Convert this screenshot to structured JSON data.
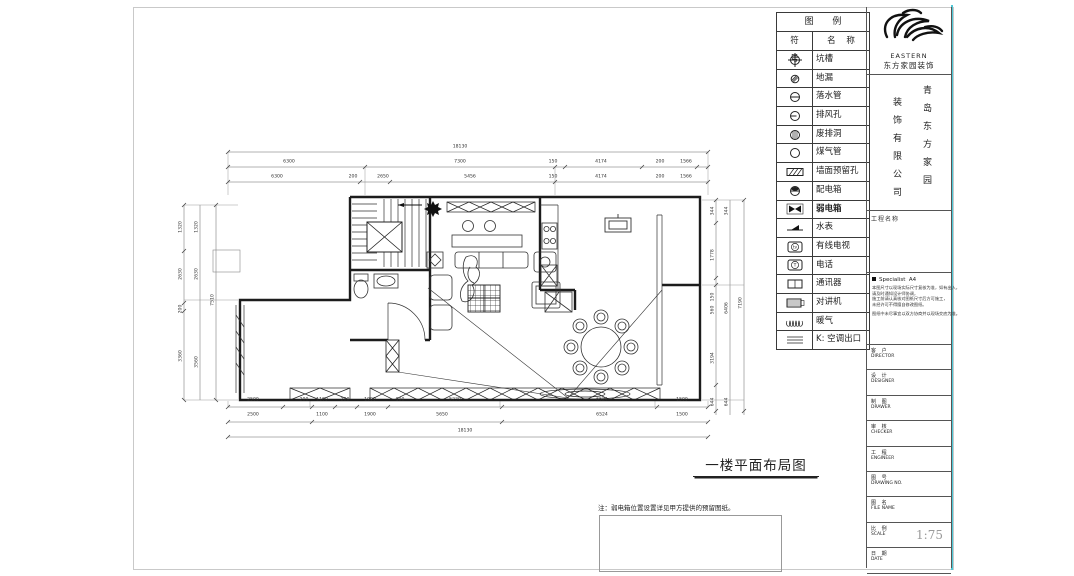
{
  "legend": {
    "title": "图  例",
    "col_symbol": "符 号",
    "col_name": "名 称",
    "items": [
      {
        "name": "坑槽",
        "symbol": "crosshair-circle"
      },
      {
        "name": "地漏",
        "symbol": "hatched-circle"
      },
      {
        "name": "落水管",
        "symbol": "line-circle"
      },
      {
        "name": "排风孔",
        "symbol": "vent-circle"
      },
      {
        "name": "废排洞",
        "symbol": "grill-circle"
      },
      {
        "name": "煤气管",
        "symbol": "plain-circle"
      },
      {
        "name": "墙面预留孔",
        "symbol": "hatched-rect"
      },
      {
        "name": "配电箱",
        "symbol": "half-filled-circle"
      },
      {
        "name": "弱电箱",
        "symbol": "bowtie",
        "bold": true
      },
      {
        "name": "水表",
        "symbol": "water-meter"
      },
      {
        "name": "有线电视",
        "symbol": "tv-box"
      },
      {
        "name": "电话",
        "symbol": "phone-box"
      },
      {
        "name": "通讯器",
        "symbol": "comm-box"
      },
      {
        "name": "对讲机",
        "symbol": "intercom-box"
      },
      {
        "name": "暖气",
        "symbol": "radiator-coil"
      },
      {
        "name": "K: 空调出口",
        "symbol": "parallel-lines"
      }
    ]
  },
  "company": {
    "brand_en": "EASTERN",
    "brand_cn": "东方家园装饰",
    "name_col_right": "青岛东方家园",
    "name_col_left": "装饰有限公司",
    "project_label": "工程名称"
  },
  "titleblock": {
    "header_left": "Specialist",
    "header_right": "A4",
    "notes": [
      "本图尺寸以现场实际尺寸复核为准，如有出入，",
      "请及时通知设计师协调，",
      "施工前请认真核对图纸尺寸后方可施工，",
      "未经许可不得擅自修改图纸。"
    ],
    "note_extra": "图纸中未尽事宜以双方协商并以现场交底为准。",
    "rows": [
      {
        "cn": "客 户",
        "en": "DIRECTOR",
        "value": ""
      },
      {
        "cn": "设 计",
        "en": "DESIGNER",
        "value": ""
      },
      {
        "cn": "制 图",
        "en": "DRAWER",
        "value": ""
      },
      {
        "cn": "审 核",
        "en": "CHECKER",
        "value": ""
      },
      {
        "cn": "工 程",
        "en": "ENGINEER",
        "value": ""
      },
      {
        "cn": "图 号",
        "en": "DRAWING NO.",
        "value": ""
      },
      {
        "cn": "图 名",
        "en": "FILE NAME",
        "value": ""
      },
      {
        "cn": "比 例",
        "en": "SCALE",
        "value": "1:75"
      },
      {
        "cn": "日 期",
        "en": "DATE",
        "value": ""
      }
    ]
  },
  "plan": {
    "title": "一楼平面布局图",
    "note": "注：弱电箱位置设置详见甲方提供的预留图纸。",
    "dims": {
      "top1": [
        "18130"
      ],
      "top2": [
        "6300",
        "7300",
        "150",
        "4174",
        "200",
        "1566"
      ],
      "top3": [
        "6300",
        "200",
        "2650",
        "5456",
        "150",
        "4174",
        "200",
        "1566"
      ],
      "bottom1": [
        "2500",
        "200",
        "1100",
        "200",
        "1900",
        "100",
        "5230",
        "6524",
        "1500"
      ],
      "bottom2": [
        "2500",
        "1100",
        "1900",
        "5650",
        "6524",
        "1500"
      ],
      "bottom3": [
        "18130"
      ],
      "left1": [
        "1320",
        "2630",
        "200",
        "3360"
      ],
      "left2": [
        "1320",
        "2630",
        "3560"
      ],
      "left3": [
        "7510"
      ],
      "right1": [
        "344",
        "1778",
        "150",
        "560",
        "3194",
        "644"
      ],
      "right2": [
        "344",
        "6406",
        "644"
      ],
      "right3": [
        "7190"
      ]
    }
  }
}
